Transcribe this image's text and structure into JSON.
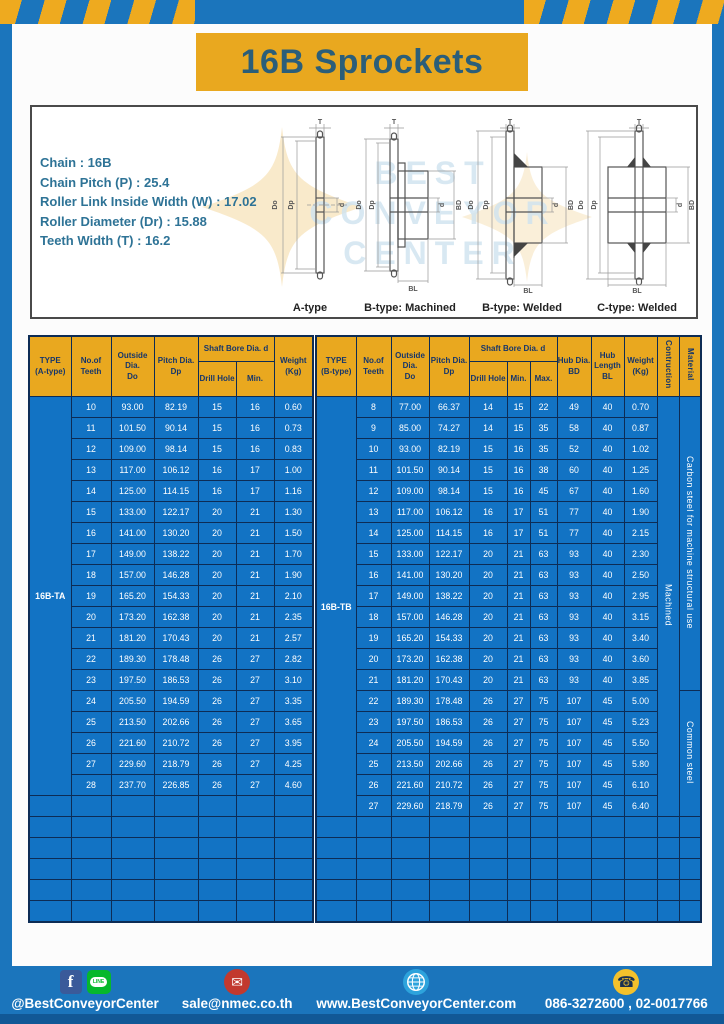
{
  "page": {
    "title": "16B Sprockets"
  },
  "specs": {
    "lines": [
      "Chain  :  16B",
      "Chain Pitch (P)  :  25.4",
      "Roller Link Inside Width (W)  :  17.02",
      "Roller Diameter (Dr)  : 15.88",
      "Teeth Width (T)  :  16.2"
    ]
  },
  "watermark": {
    "lines": [
      "BEST",
      "CONVEYOR",
      "CENTER"
    ]
  },
  "diagrams": {
    "labels": [
      "A-type",
      "B-type: Machined",
      "B-type: Welded",
      "C-type: Welded"
    ],
    "dims": {
      "t": "T",
      "do": "Do",
      "dp": "Dp",
      "d": "d",
      "bd": "BD",
      "bl": "BL"
    }
  },
  "colors": {
    "frame_blue": "#1b75bc",
    "stripe_yellow": "#eeaa1f",
    "banner_yellow": "#e9a81f",
    "title_text": "#2b5e79",
    "spec_text": "#2e7396",
    "header_yellow": "#e9a81f",
    "header_text": "#16366b",
    "cell_blue": "#1273c4",
    "cell_border": "#0d2c55",
    "cell_text": "#ffffff",
    "footer_blue": "#1b75bc",
    "divider_yellow": "#ddc022"
  },
  "icons": {
    "facebook_glyph": "f",
    "line_glyph": "LINE",
    "email_glyph": "✉",
    "phone_glyph": "☎"
  },
  "tables": {
    "left": {
      "name": "a-type-table",
      "col_widths": [
        42,
        40,
        43,
        44,
        38,
        38,
        39
      ],
      "header_rows": [
        [
          {
            "t": [
              "TYPE",
              "(A-type)"
            ],
            "rs": 2
          },
          {
            "t": [
              "No.of",
              "Teeth"
            ],
            "rs": 2
          },
          {
            "t": [
              "Outside",
              "Dia.",
              "Do"
            ],
            "rs": 2
          },
          {
            "t": [
              "Pitch Dia.",
              "Dp"
            ],
            "rs": 2
          },
          {
            "t": [
              "Shaft Bore Dia. d"
            ],
            "cs": 2
          },
          {
            "t": [
              "Weight",
              "(Kg)"
            ],
            "rs": 2
          }
        ],
        [
          {
            "t": [
              "Drill Hole"
            ]
          },
          {
            "t": [
              "Min."
            ]
          }
        ]
      ],
      "row_spans": [
        {
          "row": 0,
          "side": "start",
          "label": "16B-TA",
          "rowspan": 19,
          "cls": "type-cell",
          "name": "type-label-cell"
        }
      ],
      "rows": [
        [
          "10",
          "93.00",
          "82.19",
          "15",
          "16",
          "0.60"
        ],
        [
          "11",
          "101.50",
          "90.14",
          "15",
          "16",
          "0.73"
        ],
        [
          "12",
          "109.00",
          "98.14",
          "15",
          "16",
          "0.83"
        ],
        [
          "13",
          "117.00",
          "106.12",
          "16",
          "17",
          "1.00"
        ],
        [
          "14",
          "125.00",
          "114.15",
          "16",
          "17",
          "1.16"
        ],
        [
          "15",
          "133.00",
          "122.17",
          "20",
          "21",
          "1.30"
        ],
        [
          "16",
          "141.00",
          "130.20",
          "20",
          "21",
          "1.50"
        ],
        [
          "17",
          "149.00",
          "138.22",
          "20",
          "21",
          "1.70"
        ],
        [
          "18",
          "157.00",
          "146.28",
          "20",
          "21",
          "1.90"
        ],
        [
          "19",
          "165.20",
          "154.33",
          "20",
          "21",
          "2.10"
        ],
        [
          "20",
          "173.20",
          "162.38",
          "20",
          "21",
          "2.35"
        ],
        [
          "21",
          "181.20",
          "170.43",
          "20",
          "21",
          "2.57"
        ],
        [
          "22",
          "189.30",
          "178.48",
          "26",
          "27",
          "2.82"
        ],
        [
          "23",
          "197.50",
          "186.53",
          "26",
          "27",
          "3.10"
        ],
        [
          "24",
          "205.50",
          "194.59",
          "26",
          "27",
          "3.35"
        ],
        [
          "25",
          "213.50",
          "202.66",
          "26",
          "27",
          "3.65"
        ],
        [
          "26",
          "221.60",
          "210.72",
          "26",
          "27",
          "3.95"
        ],
        [
          "27",
          "229.60",
          "218.79",
          "26",
          "27",
          "4.25"
        ],
        [
          "28",
          "237.70",
          "226.85",
          "26",
          "27",
          "4.60"
        ]
      ],
      "empty_rows": 6,
      "empty_cols": 7
    },
    "right": {
      "name": "b-type-table",
      "col_widths": [
        40,
        35,
        38,
        40,
        38,
        23,
        27,
        34,
        33,
        33,
        22,
        22
      ],
      "header_rows": [
        [
          {
            "t": [
              "TYPE",
              "(B-type)"
            ],
            "rs": 2
          },
          {
            "t": [
              "No.of",
              "Teeth"
            ],
            "rs": 2
          },
          {
            "t": [
              "Outside",
              "Dia.",
              "Do"
            ],
            "rs": 2
          },
          {
            "t": [
              "Pitch Dia.",
              "Dp"
            ],
            "rs": 2
          },
          {
            "t": [
              "Shaft Bore Dia. d"
            ],
            "cs": 3
          },
          {
            "t": [
              "Hub Dia.",
              "BD"
            ],
            "rs": 2
          },
          {
            "t": [
              "Hub",
              "Length",
              "BL"
            ],
            "rs": 2
          },
          {
            "t": [
              "Weight",
              "(Kg)"
            ],
            "rs": 2
          },
          {
            "t": [
              "Contruction"
            ],
            "rs": 2,
            "cls": "vert"
          },
          {
            "t": [
              "Material"
            ],
            "rs": 2,
            "cls": "vert"
          }
        ],
        [
          {
            "t": [
              "Drill Hole"
            ]
          },
          {
            "t": [
              "Min."
            ]
          },
          {
            "t": [
              "Max."
            ]
          }
        ]
      ],
      "row_spans": [
        {
          "row": 0,
          "side": "start",
          "label": "16B-TB",
          "rowspan": 20,
          "cls": "type-cell",
          "name": "type-label-cell"
        },
        {
          "row": 0,
          "side": "end",
          "label": "Machined",
          "rowspan": 20,
          "cls": "vert",
          "name": "construction-cell"
        },
        {
          "row": 0,
          "side": "end",
          "label": "Carbon steel for machine structural use",
          "rowspan": 14,
          "cls": "vert",
          "name": "material-cell"
        },
        {
          "row": 14,
          "side": "end",
          "label": "Common steel",
          "rowspan": 6,
          "cls": "vert",
          "name": "material-cell"
        }
      ],
      "rows": [
        [
          "8",
          "77.00",
          "66.37",
          "14",
          "15",
          "22",
          "49",
          "40",
          "0.70"
        ],
        [
          "9",
          "85.00",
          "74.27",
          "14",
          "15",
          "35",
          "58",
          "40",
          "0.87"
        ],
        [
          "10",
          "93.00",
          "82.19",
          "15",
          "16",
          "35",
          "52",
          "40",
          "1.02"
        ],
        [
          "11",
          "101.50",
          "90.14",
          "15",
          "16",
          "38",
          "60",
          "40",
          "1.25"
        ],
        [
          "12",
          "109.00",
          "98.14",
          "15",
          "16",
          "45",
          "67",
          "40",
          "1.60"
        ],
        [
          "13",
          "117.00",
          "106.12",
          "16",
          "17",
          "51",
          "77",
          "40",
          "1.90"
        ],
        [
          "14",
          "125.00",
          "114.15",
          "16",
          "17",
          "51",
          "77",
          "40",
          "2.15"
        ],
        [
          "15",
          "133.00",
          "122.17",
          "20",
          "21",
          "63",
          "93",
          "40",
          "2.30"
        ],
        [
          "16",
          "141.00",
          "130.20",
          "20",
          "21",
          "63",
          "93",
          "40",
          "2.50"
        ],
        [
          "17",
          "149.00",
          "138.22",
          "20",
          "21",
          "63",
          "93",
          "40",
          "2.95"
        ],
        [
          "18",
          "157.00",
          "146.28",
          "20",
          "21",
          "63",
          "93",
          "40",
          "3.15"
        ],
        [
          "19",
          "165.20",
          "154.33",
          "20",
          "21",
          "63",
          "93",
          "40",
          "3.40"
        ],
        [
          "20",
          "173.20",
          "162.38",
          "20",
          "21",
          "63",
          "93",
          "40",
          "3.60"
        ],
        [
          "21",
          "181.20",
          "170.43",
          "20",
          "21",
          "63",
          "93",
          "40",
          "3.85"
        ],
        [
          "22",
          "189.30",
          "178.48",
          "26",
          "27",
          "75",
          "107",
          "45",
          "5.00"
        ],
        [
          "23",
          "197.50",
          "186.53",
          "26",
          "27",
          "75",
          "107",
          "45",
          "5.23"
        ],
        [
          "24",
          "205.50",
          "194.59",
          "26",
          "27",
          "75",
          "107",
          "45",
          "5.50"
        ],
        [
          "25",
          "213.50",
          "202.66",
          "26",
          "27",
          "75",
          "107",
          "45",
          "5.80"
        ],
        [
          "26",
          "221.60",
          "210.72",
          "26",
          "27",
          "75",
          "107",
          "45",
          "6.10"
        ],
        [
          "27",
          "229.60",
          "218.79",
          "26",
          "27",
          "75",
          "107",
          "45",
          "6.40"
        ]
      ],
      "empty_rows": 5,
      "empty_cols": 12
    }
  },
  "footer": {
    "items": [
      {
        "text": "@BestConveyorCenter"
      },
      {
        "text": "sale@nmec.co.th"
      },
      {
        "text": "www.BestConveyorCenter.com"
      },
      {
        "text": "086-3272600 , 02-0017766"
      }
    ]
  }
}
